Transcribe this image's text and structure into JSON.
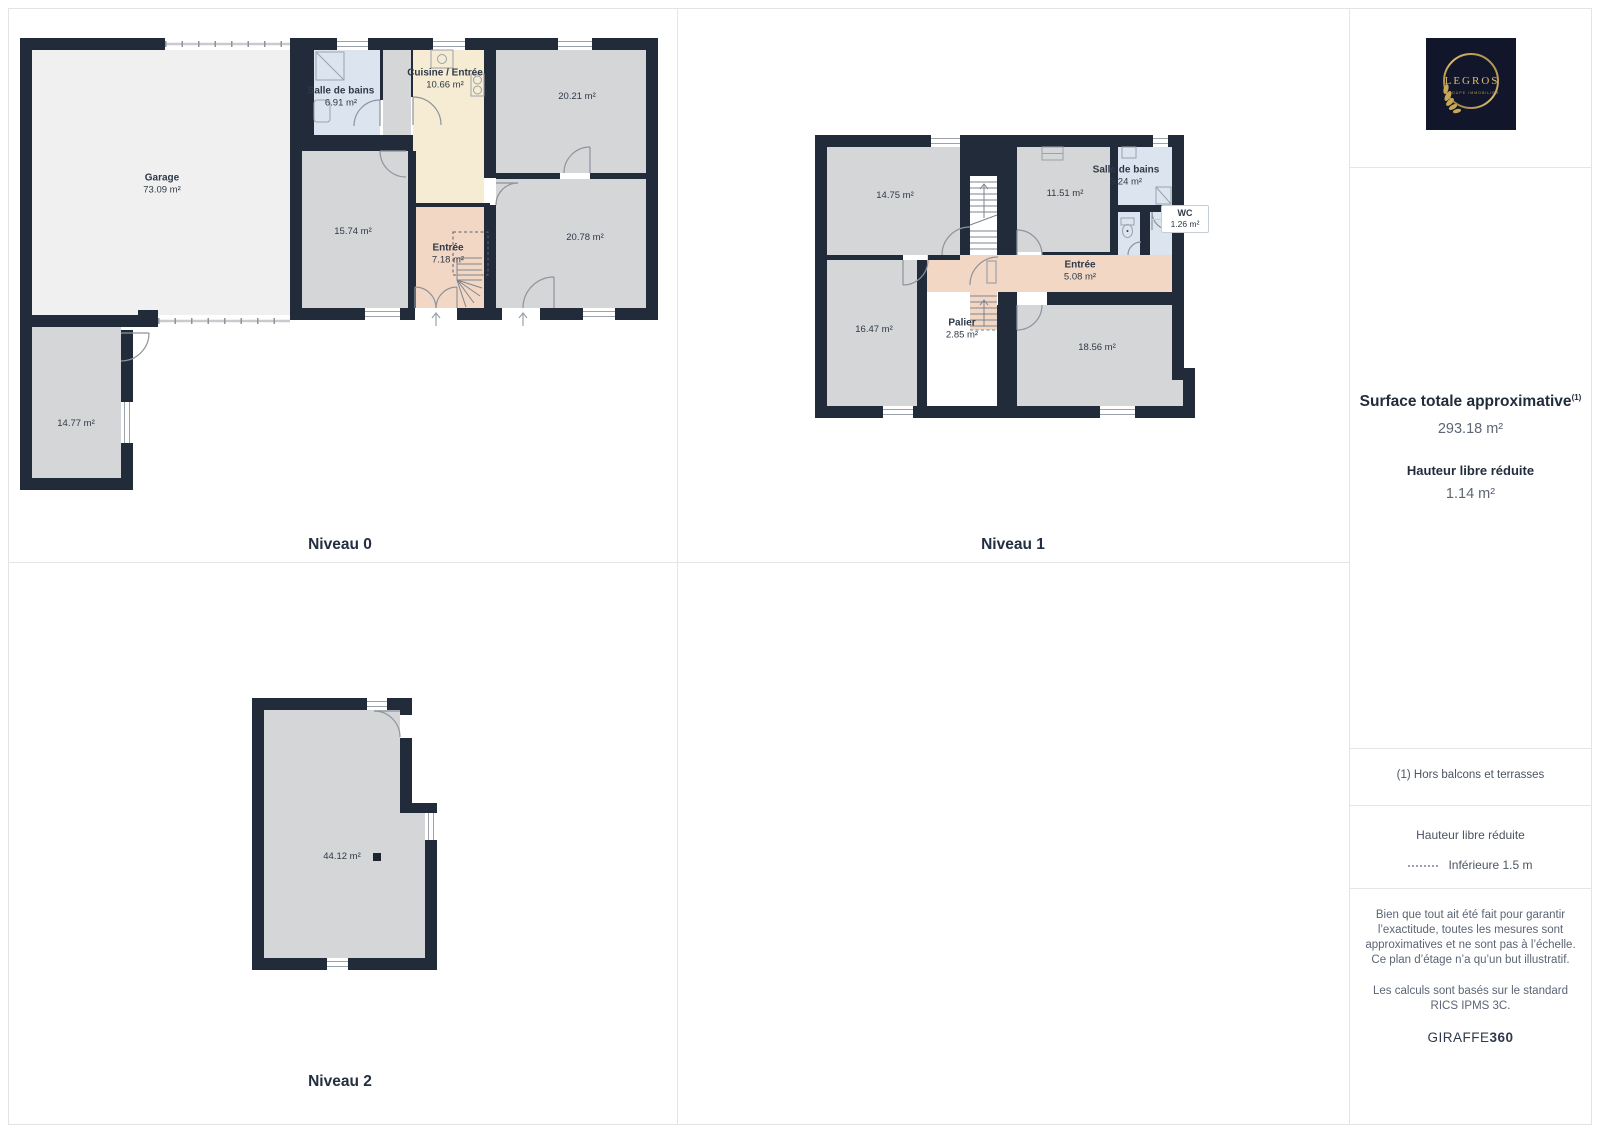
{
  "palette": {
    "wall": "#212b3a",
    "room_gray": "#d5d6d7",
    "garage_light": "#f0f0f1",
    "bathroom_blue": "#dce4f0",
    "kitchen_cream": "#f6ebd3",
    "entry_salmon": "#f3d7c5",
    "label_text": "#2e3948",
    "grid_line": "#e4e5e7",
    "logo_bg": "#11162b",
    "logo_gold": "#c2a04f"
  },
  "floors": [
    {
      "caption": "Niveau 0",
      "rooms": {
        "garage": {
          "name": "Garage",
          "area": "73.09 m²"
        },
        "salle_de_bains": {
          "name": "Salle de bains",
          "area": "6.91 m²"
        },
        "cuisine": {
          "name": "Cuisine / Entrée",
          "area": "10.66 m²"
        },
        "piece_20_21": {
          "area": "20.21 m²"
        },
        "piece_15_74": {
          "area": "15.74 m²"
        },
        "entree": {
          "name": "Entrée",
          "area": "7.18 m²"
        },
        "piece_20_78": {
          "area": "20.78 m²"
        },
        "annexe": {
          "area": "14.77 m²"
        }
      }
    },
    {
      "caption": "Niveau 1",
      "rooms": {
        "piece_14_75": {
          "area": "14.75 m²"
        },
        "piece_11_51": {
          "area": "11.51 m²"
        },
        "salle_de_bains": {
          "name": "Salle de bains",
          "area": "5.24 m²"
        },
        "wc": {
          "name": "WC",
          "area": "1.26 m²"
        },
        "entree": {
          "name": "Entrée",
          "area": "5.08 m²"
        },
        "piece_16_47": {
          "area": "16.47 m²"
        },
        "palier": {
          "name": "Palier",
          "area": "2.85 m²"
        },
        "piece_18_56": {
          "area": "18.56 m²"
        }
      }
    },
    {
      "caption": "Niveau 2",
      "rooms": {
        "piece_44_12": {
          "area": "44.12 m²"
        }
      }
    }
  ],
  "sidebar": {
    "logo": {
      "brand": "LEGROS",
      "subtitle": "GROUPE IMMOBILIER"
    },
    "surface_title": "Surface totale approximative",
    "surface_footnote": "(1)",
    "surface_value": "293.18 m²",
    "reduced_height_label": "Hauteur libre réduite",
    "reduced_height_value": "1.14 m²",
    "footnote": "(1) Hors balcons et terrasses",
    "legend_title": "Hauteur libre réduite",
    "legend_item": "Inférieure 1.5 m",
    "disclaimer1": "Bien que tout ait été fait pour garantir l’exactitude, toutes les mesures sont approximatives et ne sont pas à l’échelle. Ce plan d’étage n’a qu’un but illustratif.",
    "disclaimer2": "Les calculs sont basés sur le standard RICS IPMS 3C.",
    "brand_footer": {
      "name": "GIRAFFE",
      "suffix": "360"
    }
  }
}
